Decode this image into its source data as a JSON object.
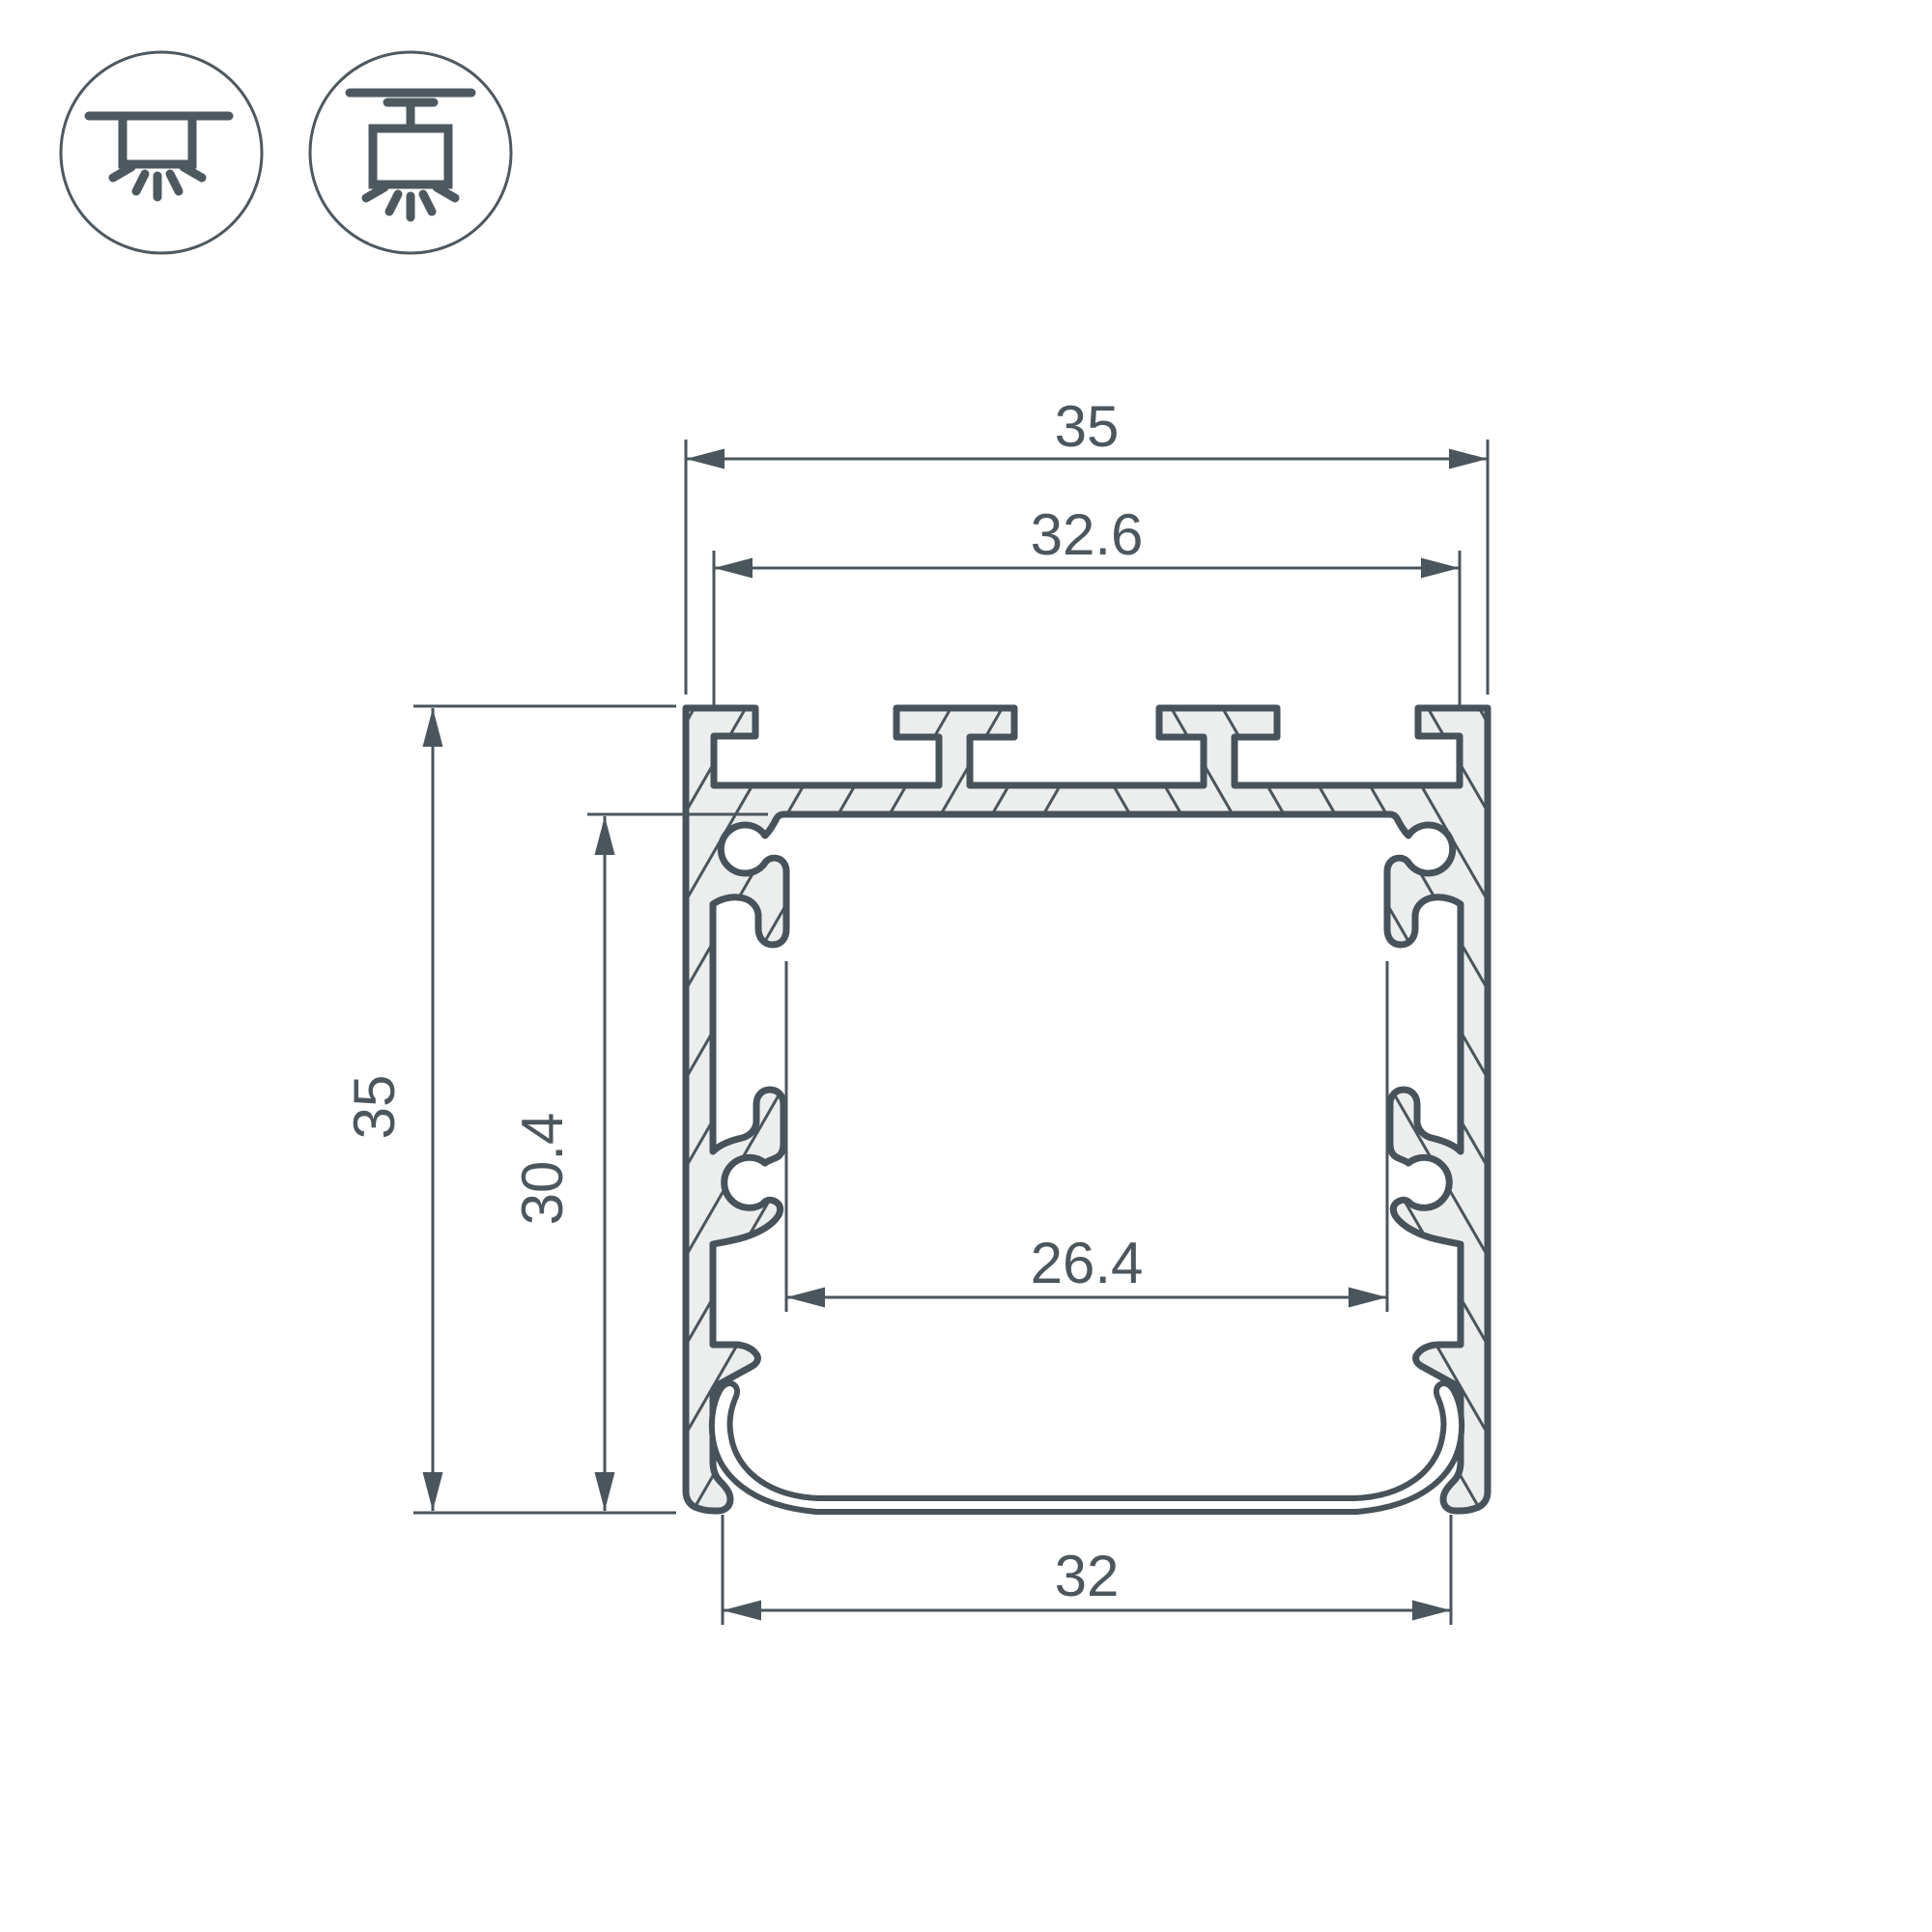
{
  "drawing": {
    "title": "led-profile-cross-section",
    "dims": {
      "overall_width": "35",
      "top_groove_width": "32.6",
      "overall_height": "35",
      "inner_height": "30.4",
      "led_platform_width": "26.4",
      "bottom_opening_width": "32"
    }
  },
  "icons": {
    "surface_mount": "surface-ceiling-mount-light-icon",
    "pendant_mount": "pendant-suspended-mount-light-icon"
  },
  "colors": {
    "outline": "#47525A",
    "dimension_line": "#4A555C",
    "text": "#4C565D",
    "aluminum_fill": "#ECEDED",
    "background": "#FFFFFF"
  }
}
